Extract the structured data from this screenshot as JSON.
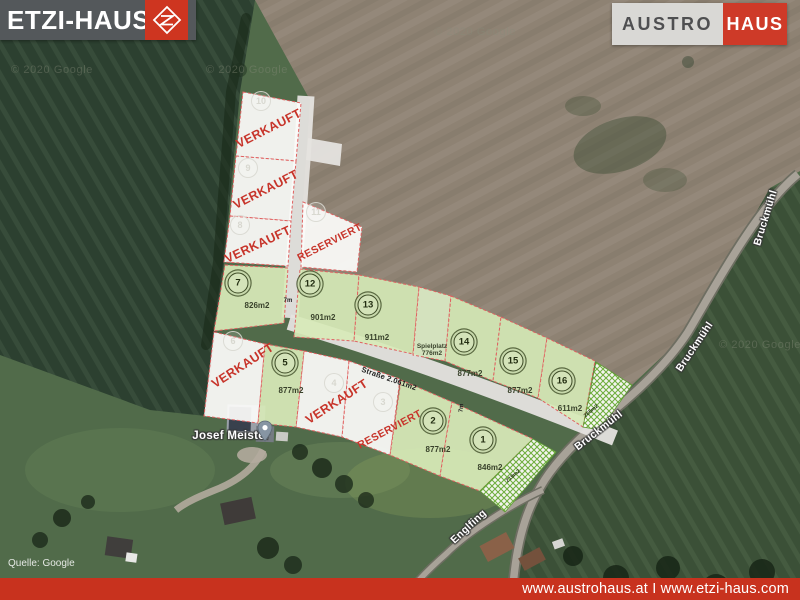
{
  "header": {
    "etzi_logo": "ETZI-HAUS",
    "austro_logo_left": "AUSTRO",
    "austro_logo_right": "HAUS"
  },
  "footer": {
    "links": "www.austrohaus.at I www.etzi-haus.com"
  },
  "labels": {
    "place": "Josef Meister",
    "street_bruckmuehl": "Bruckmühl",
    "street_englfing": "Englfing",
    "road_area": "Straße 2.061m2",
    "dim_a": "7m",
    "dim_b": "7m",
    "strip_a": "265m2",
    "strip_b": "219m2",
    "watermark": "© 2020 Google",
    "source": "Quelle: Google",
    "playground_name": "Spielplatz",
    "playground_area": "776m2"
  },
  "plots": {
    "available": [
      {
        "number": "7",
        "area": "826m2"
      },
      {
        "number": "12",
        "area": "901m2"
      },
      {
        "number": "13",
        "area": "911m2"
      },
      {
        "number": "14",
        "area": "877m2"
      },
      {
        "number": "15",
        "area": "877m2"
      },
      {
        "number": "16",
        "area": "611m2"
      },
      {
        "number": "5",
        "area": "877m2"
      },
      {
        "number": "2",
        "area": "877m2"
      },
      {
        "number": "1",
        "area": "846m2"
      }
    ],
    "unavailable": [
      {
        "number": "10",
        "status": "VERKAUFT"
      },
      {
        "number": "9",
        "status": "VERKAUFT"
      },
      {
        "number": "8",
        "status": "VERKAUFT"
      },
      {
        "number": "11",
        "status": "RESERVIERT"
      },
      {
        "number": "6",
        "status": "VERKAUFT"
      },
      {
        "number": "4",
        "status": "VERKAUFT"
      },
      {
        "number": "3",
        "status": "RESERVIERT"
      }
    ]
  },
  "colors": {
    "brand_red": "#ce3520",
    "footer_red": "#c8321e",
    "plot_green": "#d7e9b8",
    "plot_white": "#fcfcfa",
    "plot_border_red": "#e06060",
    "sold_text_red": "#c7342a",
    "hatch_green": "#6fae3e"
  }
}
